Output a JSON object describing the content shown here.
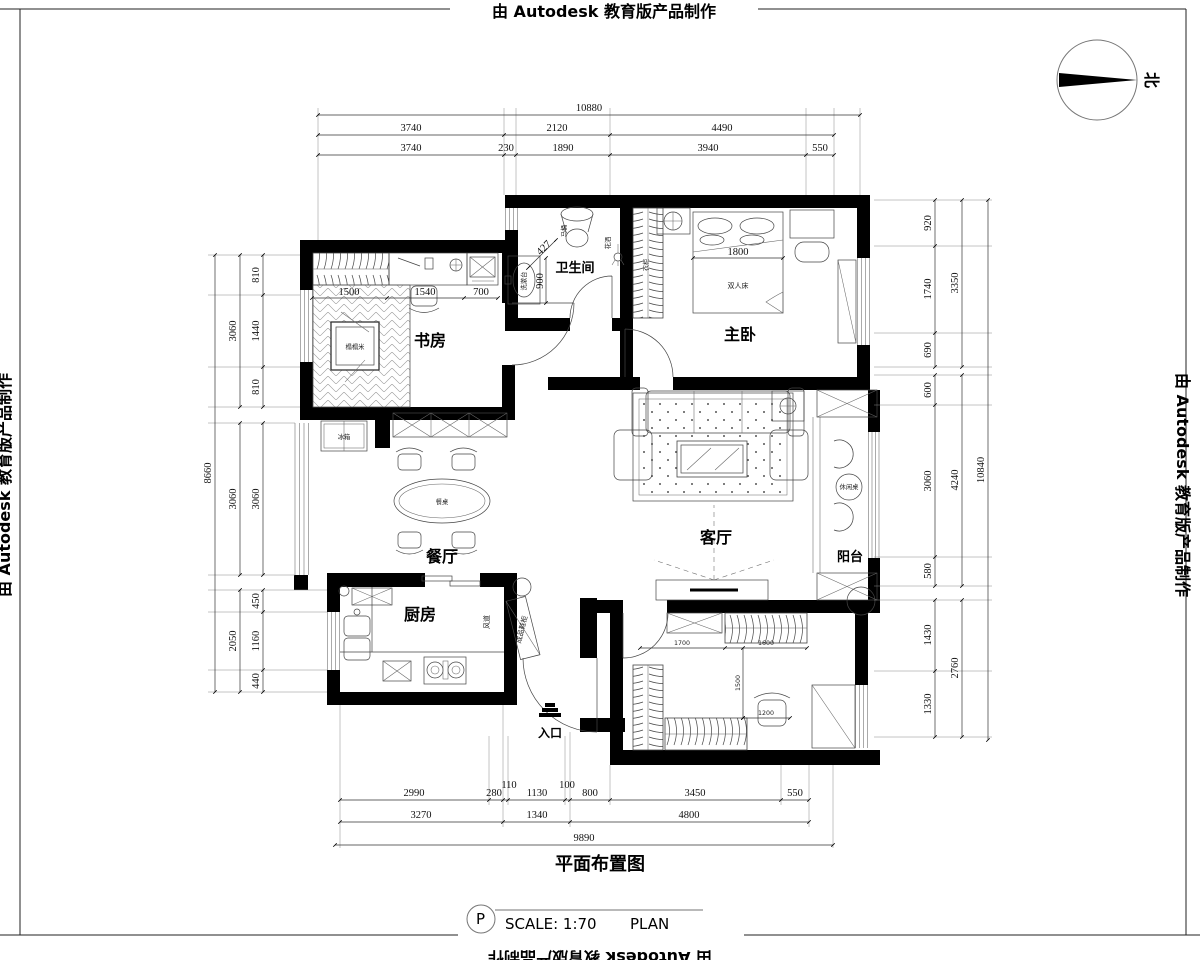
{
  "border": {
    "top": "由 Autodesk 教育版产品制作",
    "left": "由 Autodesk 教育版产品制作",
    "right": "由 Autodesk 教育版产品制作",
    "bottom": "由 Autodesk 教育版产品制作"
  },
  "north_label": "北",
  "title_block": {
    "drawing_title": "平面布置图",
    "tag": "P",
    "scale": "SCALE: 1:70",
    "type": "PLAN"
  },
  "rooms": {
    "study": "书房",
    "bathroom": "卫生间",
    "master_bedroom": "主卧",
    "dining": "餐厅",
    "living": "客厅",
    "balcony": "阳台",
    "kitchen": "厨房",
    "entrance": "入口"
  },
  "furniture": {
    "double_bed": "双人床",
    "dining_table": "餐桌",
    "fridge": "冰箱",
    "tatami": "榻榻米",
    "toilet": "马桶",
    "shower": "花洒",
    "basin": "洗漱台",
    "leisure_table": "休闲桌",
    "shoe_cabinet": "成品鞋柜",
    "wardrobe": "衣柜",
    "duct": "风道"
  },
  "dims": {
    "top_overall": "10880",
    "top_mid": [
      "3740",
      "2120",
      "4490"
    ],
    "top_inner": [
      "3740",
      "230",
      "1890",
      "3940",
      "550"
    ],
    "bottom_inner": [
      "2990",
      "280",
      "110",
      "1130",
      "100",
      "800",
      "3450",
      "550"
    ],
    "bottom_mid": [
      "3270",
      "1340",
      "4800"
    ],
    "bottom_overall": "9890",
    "left_overall": "8660",
    "left_mid": [
      "3060",
      "3060",
      "2050"
    ],
    "left_inner": [
      "810",
      "1440",
      "810",
      "3060",
      "450",
      "1160",
      "440"
    ],
    "right_inner": [
      "920",
      "1740",
      "690",
      "600",
      "3060",
      "580",
      "1430",
      "1330"
    ],
    "right_mid": [
      "3350",
      "4240",
      "2760"
    ],
    "right_overall": "10840",
    "study_inner": [
      "1500",
      "1540",
      "700"
    ],
    "bed_width": "1800",
    "bath_inner": [
      "900",
      "427"
    ],
    "room2_inner": [
      "1700",
      "1600",
      "1500",
      "1200"
    ]
  }
}
